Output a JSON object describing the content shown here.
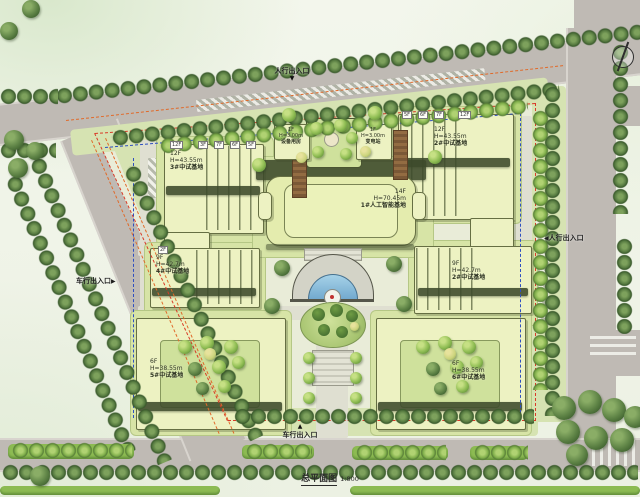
{
  "plan": {
    "title": "总平面图",
    "scale": "1:800"
  },
  "entrances": {
    "top": {
      "label": "人行出入口",
      "marker": "▼"
    },
    "right": {
      "marker": "◀",
      "label": "人行出入口"
    },
    "left": {
      "label": "车行出入口",
      "marker": "▶"
    },
    "bottom": {
      "marker": "▲",
      "label": "车行出入口"
    }
  },
  "buildings": {
    "center": {
      "floors": "14F",
      "height": "H=70.45m",
      "name": "1#人工智能基地"
    },
    "top_left": {
      "floors": "12F",
      "height": "H=43.55m",
      "name": "3#中试基地"
    },
    "top_right": {
      "floors": "12F",
      "height": "H=43.55m",
      "name": "2#中试基地"
    },
    "mid_left": {
      "floors": "9F",
      "height": "H=42.7m",
      "name": "4#中试基地"
    },
    "mid_right": {
      "floors": "9F",
      "height": "H=42.7m",
      "name": "2#中试基地"
    },
    "bottom_left": {
      "floors": "6F",
      "height": "H=38.55m",
      "name": "5#中试基地"
    },
    "bottom_right": {
      "floors": "6F",
      "height": "H=38.55m",
      "name": "6#中试基地"
    },
    "equipment_room": {
      "floors": "1F",
      "height": "H=3.00m",
      "name": "设备用房"
    },
    "substation": {
      "floors": "1F",
      "height": "H=3.00m",
      "name": "变电站"
    }
  },
  "floor_tags": [
    "12F",
    "7F",
    "6F",
    "5F",
    "3F",
    "5F",
    "6F",
    "7F",
    "12F",
    "2F"
  ],
  "colors": {
    "road": "#bfbab4",
    "site": "#e9ecd8",
    "building": "#edf2c2",
    "building_outline": "#666f43",
    "lawn": "#d7e4a6",
    "tree_dark": "#4e7340",
    "tree_bright": "#7fb347",
    "water": "#8fc0dd",
    "boundary_red": "#d93a28",
    "setback_blue": "#2f4fc0",
    "road_line_orange": "#e06a2a",
    "hedge": "#8cbb52"
  }
}
